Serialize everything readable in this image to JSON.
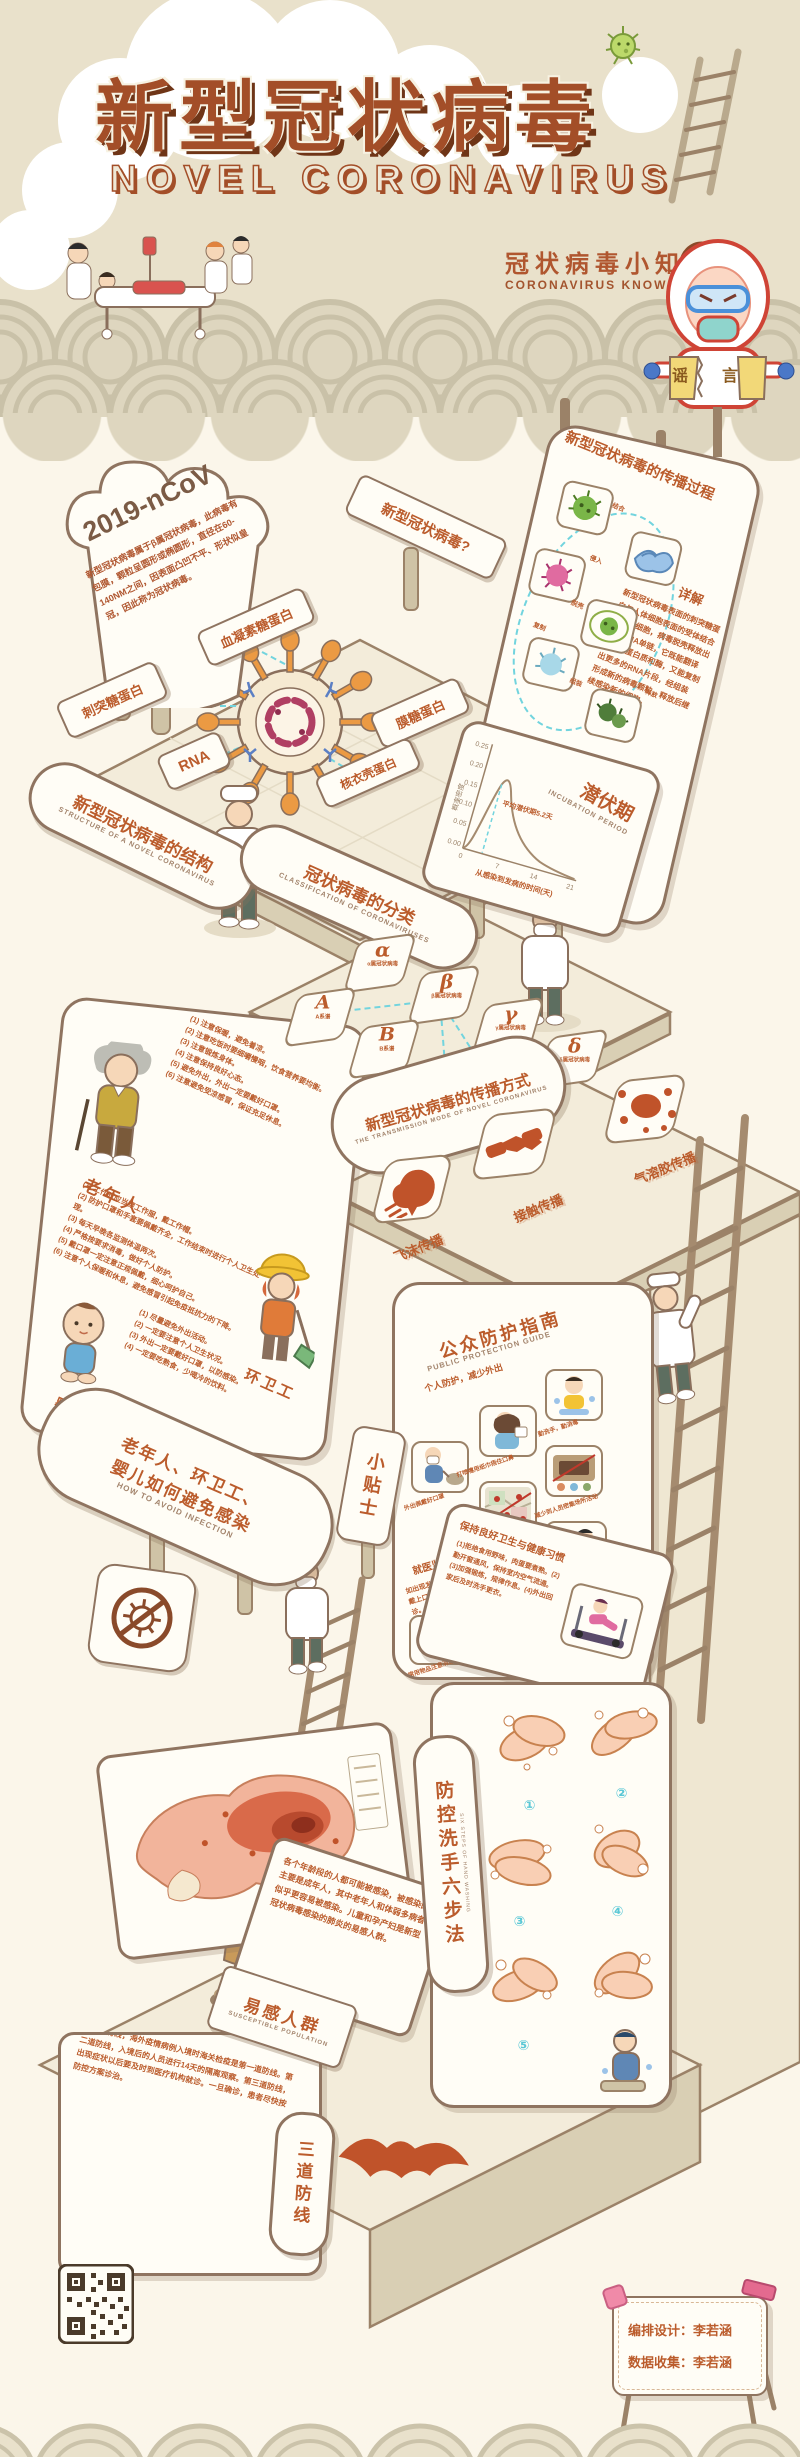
{
  "header": {
    "title_cn": "新型冠状病毒",
    "title_en": "NOVEL CORONAVIRUS",
    "tagline_cn": "冠状病毒小知识",
    "tagline_en": "CORONAVIRUS KNOWLEDGE",
    "rumor_paper": "谣言"
  },
  "intro": {
    "cloud_label": "2019-nCoV",
    "cloud_text": "新型冠状病毒属于β属冠状病毒，此病毒有包膜，颗粒呈圆形或椭圆形，直径在60-140NM之间，因表面凸凹不平、形状似皇冠，因此称为冠状病毒。",
    "question_sign": "新型冠状病毒?"
  },
  "structure": {
    "sign_cn": "新型冠状病毒的结构",
    "sign_en": "STRUCTURE OF A NOVEL CORONAVIRUS",
    "labels": {
      "hemagglutinin": "血凝素糖蛋白",
      "spike": "刺突糖蛋白",
      "rna": "RNA",
      "membrane": "膜糖蛋白",
      "nucleocapsid": "核衣壳蛋白"
    }
  },
  "spread": {
    "title": "新型冠状病毒的传播过程",
    "detail_label": "详解",
    "steps": [
      "结合",
      "侵入",
      "脱壳",
      "复制",
      "组装",
      "释放"
    ],
    "body": "新型冠状病毒表面的刺突糖蛋白与人体细胞表面的受体结合后侵入细胞，病毒脱壳释放出一条RNA单链，它既能翻译出病毒蛋白质和酶，又能复制出更多的RNA片段，经组装形成新的病毒颗粒，释放后继续感染新的细胞。"
  },
  "incubation": {
    "title_cn": "潜伏期",
    "title_en": "INCUBATION PERIOD",
    "ylabel": "概率密度",
    "xlabel": "从感染到发病的时间(天)",
    "annotation": "平均潜伏期5.2天",
    "yticks": [
      "0.25",
      "0.20",
      "0.15",
      "0.10",
      "0.05",
      "0.00"
    ],
    "xticks": [
      "0",
      "7",
      "14",
      "21"
    ]
  },
  "classification": {
    "sign_cn": "冠状病毒的分类",
    "sign_en": "CLASSIFICATION OF CORONAVIRUSES",
    "genera": [
      {
        "letter": "α",
        "caption": "α属冠状病毒"
      },
      {
        "letter": "β",
        "caption": "β属冠状病毒"
      },
      {
        "letter": "γ",
        "caption": "γ属冠状病毒"
      },
      {
        "letter": "δ",
        "caption": "δ属冠状病毒"
      }
    ],
    "lineages": [
      {
        "letter": "A",
        "caption": "A系谱"
      },
      {
        "letter": "B",
        "caption": "B系谱"
      },
      {
        "letter": "C",
        "caption": "C系谱"
      },
      {
        "letter": "D",
        "caption": "D系谱"
      }
    ]
  },
  "transmission": {
    "sign_cn": "新型冠状病毒的传播方式",
    "sign_en": "THE TRANSMISSION MODE OF NOVEL CORONAVIRUS",
    "modes": [
      "飞沫传播",
      "接触传播",
      "气溶胶传播"
    ]
  },
  "avoid": {
    "pill_cn_line1": "老年人、环卫工、",
    "pill_cn_line2": "婴儿如何避免感染",
    "pill_en": "HOW TO AVOID INFECTION",
    "tip_sign": "小贴士",
    "groups": [
      {
        "name": "老年人",
        "items": [
          "(1) 注意保暖，避免着凉。",
          "(2) 注意吃饭时要细嚼慢咽，饮食营养要均衡。",
          "(3) 注意锻炼身体。",
          "(4) 注意保持良好心态。",
          "(5) 避免外出，外出一定要戴好口罩。",
          "(6) 注意避免受凉感冒，保证充足休息。"
        ]
      },
      {
        "name": "环卫工",
        "items": [
          "(1) 工作时应当穿工作服，戴工作帽。",
          "(2) 防护口罩和手套要佩戴齐全，工作结束时进行个人卫生处理。",
          "(3) 每天早晚各监测体温两次。",
          "(4) 严格按要求消毒，做好个人防护。",
          "(5) 戴口罩一定注意正规佩戴，细心呵护自己。",
          "(6) 注意个人保暖和休息，避免感冒引起免疫抵抗力的下降。"
        ]
      },
      {
        "name": "婴儿",
        "items": [
          "(1) 尽量避免外出活动。",
          "(2) 一定要注意个人卫生状况。",
          "(3) 外出一定要戴好口罩，以防感染。",
          "(4) 一定要吃熟食，少喝冷的饮料。"
        ]
      }
    ],
    "no_virus_icon": "禁止病毒"
  },
  "guide": {
    "title_cn": "公众防护指南",
    "title_en": "PUBLIC PROTECTION GUIDE",
    "section1": "个人防护，减少外出",
    "tiles": [
      "勤洗手，勤消毒",
      "打喷嚏用纸巾捂住口鼻",
      "外出佩戴好口罩",
      "减少到人员密集场所活动",
      "避免去疫区及人群聚集场所",
      "注意营养，增强免疫力",
      "常用物品注意消毒"
    ],
    "section2": "就医监测与防控",
    "section2_text": "如出现发热、咳嗽等可疑症状，要主动戴上口罩，及时到就近的定点医院就诊。",
    "section3": "保持良好卫生与健康习惯",
    "section3_text": "(1)拒绝食用野味，肉蛋要煮熟。(2)勤开窗通风，保持室内空气流通。(3)加强锻炼，规律作息。(4)外出回家后及时洗手更衣。"
  },
  "handwash": {
    "sign": "防控洗手六步法",
    "sign_en": "SIX STEPS OF HAND WASHING",
    "steps": [
      "①",
      "②",
      "③",
      "④",
      "⑤",
      "⑥"
    ]
  },
  "susceptible": {
    "sign_cn": "易感人群",
    "sign_en": "SUSCEPTIBLE POPULATION",
    "body": "各个年龄段的人都可能被感染，被感染的主要是成年人，其中老年人和体弱多病者似乎更容易被感染。儿童和孕产妇是新型冠状病毒感染的肺炎的易感人群。"
  },
  "defense": {
    "sign": "三道防线",
    "body": "第一道防线，海外疫情病例入境时海关检疫是第一道防线。第二道防线，入境后的人员进行14天的隔离观察。第三道防线，出现症状以后要及时到医疗机构就诊。一旦确诊，患者尽快按防控方案诊治。"
  },
  "footer": {
    "credit_design": "编排设计：李若涵",
    "credit_data": "数据收集：李若涵"
  },
  "chart_data": {
    "type": "line",
    "title": "潜伏期 INCUBATION PERIOD",
    "xlabel": "从感染到发病的时间(天)",
    "ylabel": "概率密度",
    "x": [
      0,
      2,
      4,
      5.2,
      7,
      10,
      14,
      18,
      21
    ],
    "y": [
      0.0,
      0.05,
      0.15,
      0.17,
      0.13,
      0.07,
      0.03,
      0.01,
      0.005
    ],
    "xlim": [
      0,
      21
    ],
    "ylim": [
      0.0,
      0.25
    ],
    "xticks": [
      0,
      7,
      14,
      21
    ],
    "yticks": [
      0.25,
      0.2,
      0.15,
      0.1,
      0.05,
      0.0
    ],
    "annotation": "平均潜伏期5.2天",
    "grid": false,
    "legend": false
  },
  "colors": {
    "header_bg": "#e9e1cb",
    "main_bg": "#fbf6ea",
    "title_brown": "#a34e28",
    "rust_text": "#bb5c2c",
    "outline_brown": "#8f7460",
    "wave_arc": "#c9c1a8",
    "cyan_dash": "#72d4de",
    "spike_orange": "#eb9a43",
    "virus_maroon": "#b03f63",
    "bat_rust": "#c0532a"
  }
}
